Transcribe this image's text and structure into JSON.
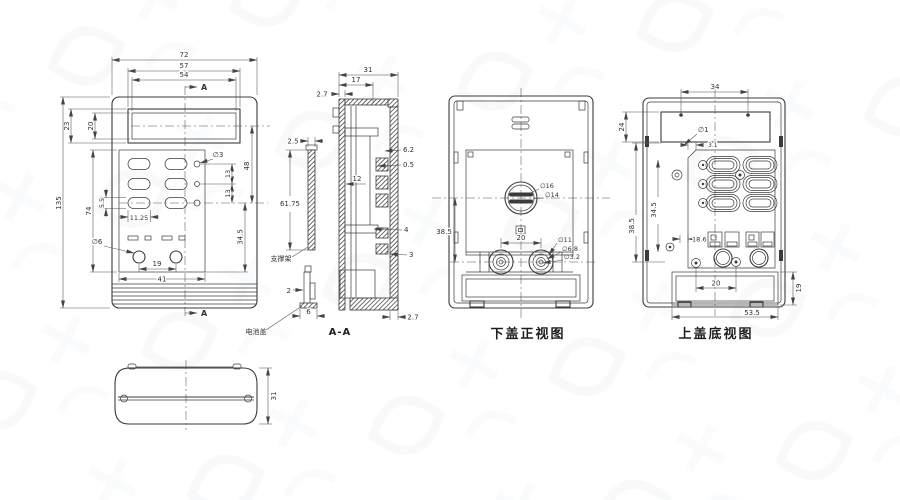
{
  "front": {
    "d72": "72",
    "d57": "57",
    "d54": "54",
    "d23": "23",
    "d20": "20",
    "d135": "135",
    "d74": "74",
    "d55": "5.5",
    "d1125": "11.25",
    "dia6": "∅6",
    "d19": "19",
    "d41": "41",
    "dia3": "∅3",
    "d13a": "13",
    "d13b": "13",
    "d48": "48",
    "d345": "34.5",
    "a": "A"
  },
  "section": {
    "d31": "31",
    "d17": "17",
    "d27t": "2.7",
    "d25": "2.5",
    "d6175": "61.75",
    "d62": "6.2",
    "d05": "0.5",
    "d12": "12",
    "d4": "4",
    "d3": "3",
    "d27b": "2.7",
    "d2": "2",
    "d6": "6",
    "support": "支撑架",
    "battery": "电池盖",
    "label": "A-A"
  },
  "bottom_cover": {
    "dia16": "∅16",
    "dia14": "∅14",
    "d385": "38.5",
    "d20": "20",
    "dia11": "∅11",
    "dia68": "∅6.8",
    "dia32": "∅3.2",
    "label": "下盖正视图"
  },
  "top_cover": {
    "d34": "34",
    "d24": "24",
    "dia1": "∅1",
    "d31": "3.1",
    "d345": "34.5",
    "d385": "38.5",
    "d186": "18.6",
    "d20": "20",
    "d19": "19",
    "d535": "53.5",
    "label": "上盖底视图"
  },
  "end_view": {
    "d31": "31"
  }
}
